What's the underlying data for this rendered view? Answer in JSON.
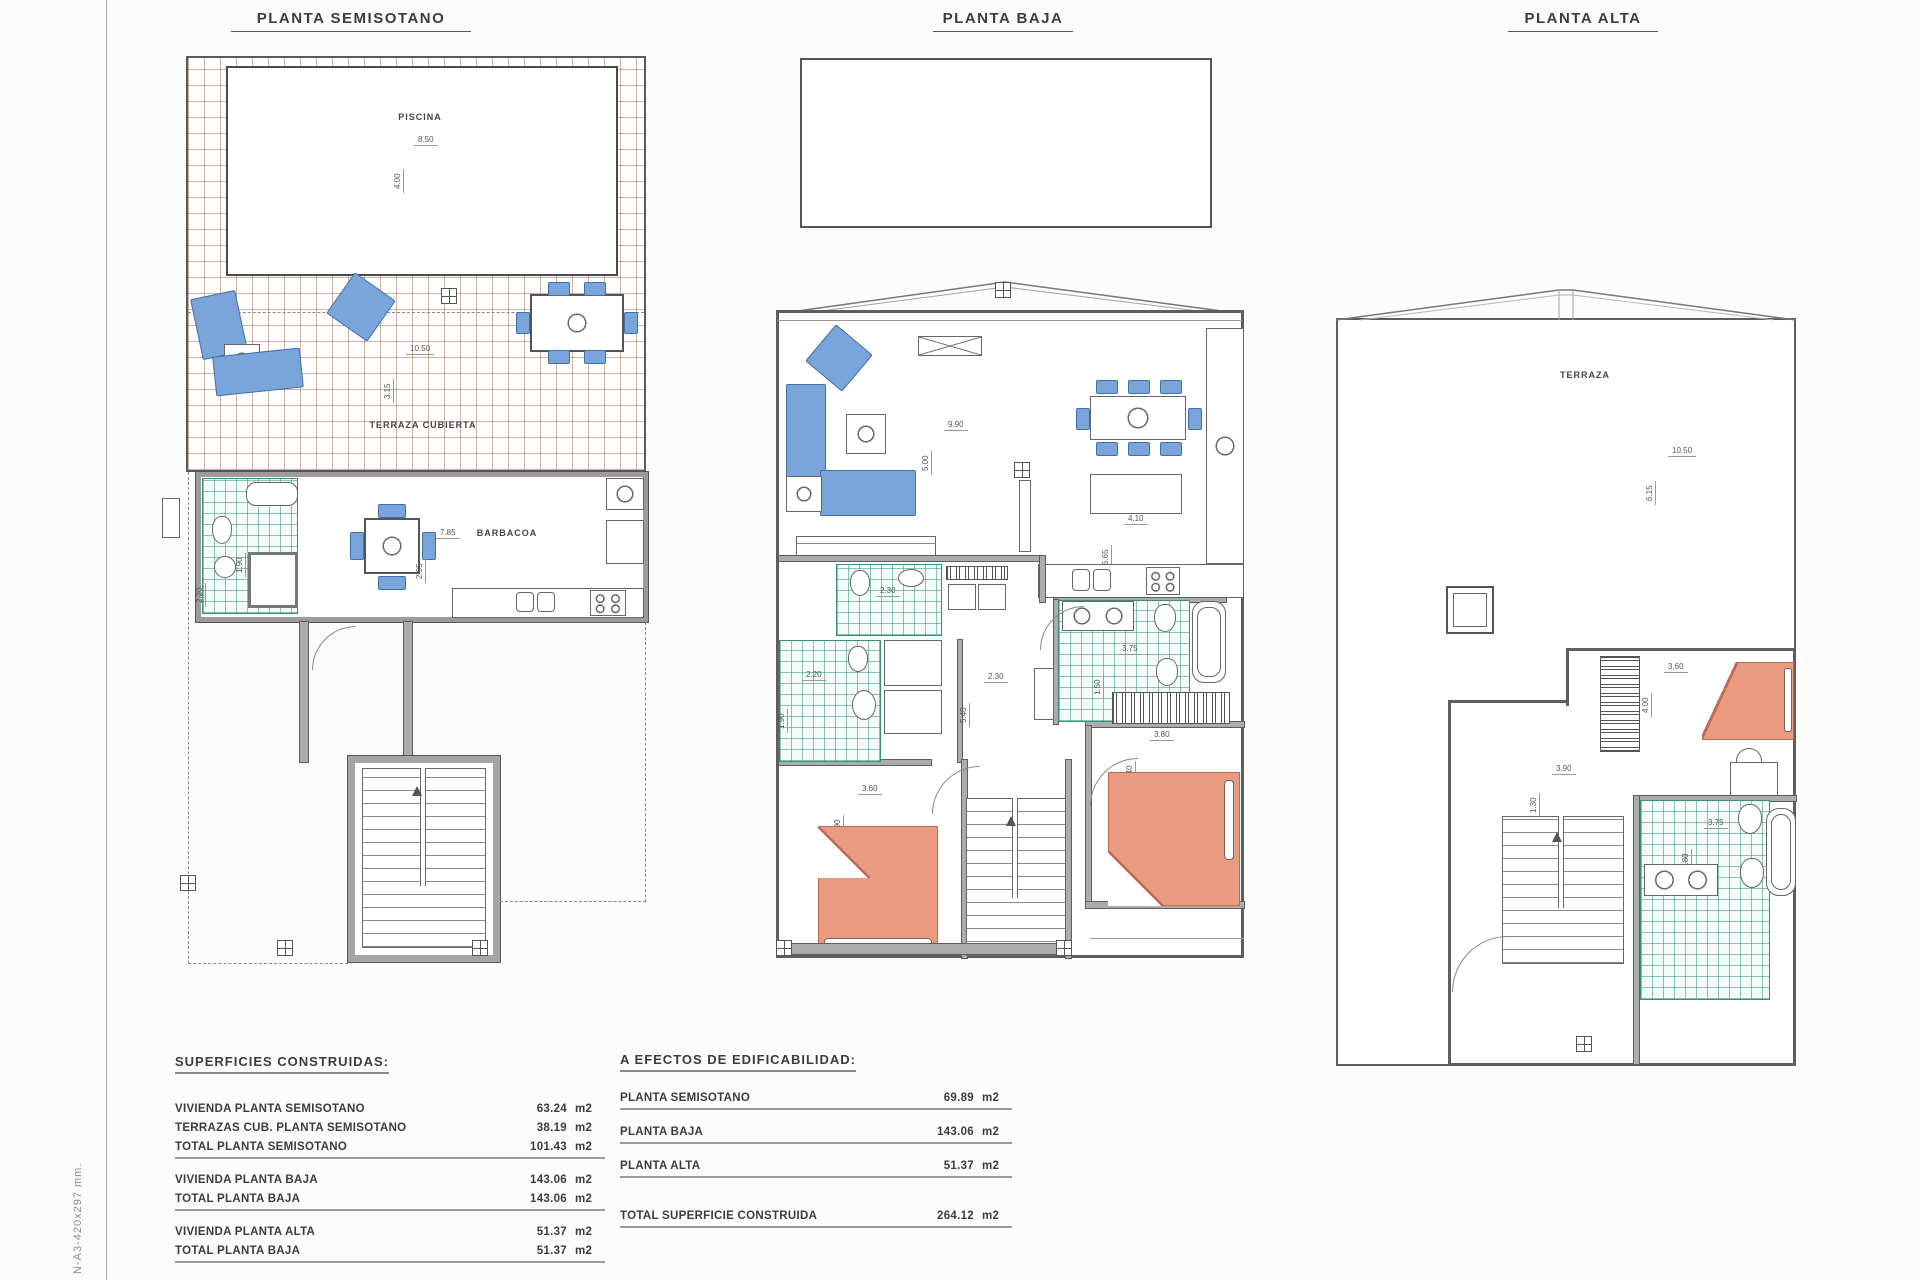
{
  "sheet": {
    "note": "N-A3-420x297 mm."
  },
  "plans": {
    "semisotano": {
      "title": "PLANTA SEMISOTANO",
      "labels": {
        "piscina": "PISCINA",
        "terraza_cubierta": "TERRAZA CUBIERTA",
        "barbacoa": "BARBACOA"
      },
      "dims": {
        "pool_w": "8.50",
        "pool_h": "4.00",
        "terrace_w": "10.50",
        "terrace_h": "3.15",
        "barbacoa_w": "7.85",
        "barbacoa_h": "2.95",
        "bath_w": "2.20",
        "bath_h": "1.90"
      }
    },
    "baja": {
      "title": "PLANTA BAJA",
      "dims": {
        "salon_w": "9.90",
        "salon_h": "5.00",
        "kitchen_w": "4.10",
        "kitchen_h": "5.65",
        "bath1_w": "2.30",
        "bath2_w": "2.20",
        "bath2_h": "1.90",
        "hall_w": "2.30",
        "hall_h": "5.40",
        "bath3_w": "3.75",
        "bath3_h": "1.50",
        "bed1_w": "3.60",
        "bed1_h": "3.90",
        "bed2_w": "3.80",
        "bed2_h": "3.40"
      }
    },
    "alta": {
      "title": "PLANTA ALTA",
      "labels": {
        "terraza": "TERRAZA"
      },
      "dims": {
        "terraza_w": "10.50",
        "terraza_h": "6.15",
        "bed_w": "3.60",
        "bed_h": "4.00",
        "landing_w": "3.90",
        "landing_h": "1.30",
        "bath_w": "3.75",
        "bath_h": "1.80"
      }
    }
  },
  "tables": {
    "superficies": {
      "heading": "SUPERFICIES CONSTRUIDAS:",
      "groups": [
        {
          "rows": [
            {
              "label": "VIVIENDA PLANTA SEMISOTANO",
              "value": "63.24",
              "unit": "m2"
            },
            {
              "label": "TERRAZAS CUB. PLANTA SEMISOTANO",
              "value": "38.19",
              "unit": "m2"
            },
            {
              "label": "TOTAL PLANTA SEMISOTANO",
              "value": "101.43",
              "unit": "m2"
            }
          ]
        },
        {
          "rows": [
            {
              "label": "VIVIENDA PLANTA BAJA",
              "value": "143.06",
              "unit": "m2"
            },
            {
              "label": "TOTAL PLANTA BAJA",
              "value": "143.06",
              "unit": "m2"
            }
          ]
        },
        {
          "rows": [
            {
              "label": "VIVIENDA PLANTA ALTA",
              "value": "51.37",
              "unit": "m2"
            },
            {
              "label": "TOTAL PLANTA BAJA",
              "value": "51.37",
              "unit": "m2"
            }
          ]
        },
        {
          "rows": [
            {
              "label": "TOTAL SUPERFICIE CONSTRUIDA",
              "value": "295.86",
              "unit": "m2"
            }
          ]
        }
      ]
    },
    "edificabilidad": {
      "heading": "A EFECTOS DE EDIFICABILIDAD:",
      "rows": [
        {
          "label": "PLANTA SEMISOTANO",
          "value": "69.89",
          "unit": "m2"
        },
        {
          "label": "PLANTA BAJA",
          "value": "143.06",
          "unit": "m2"
        },
        {
          "label": "PLANTA ALTA",
          "value": "51.37",
          "unit": "m2"
        }
      ],
      "total": {
        "label": "TOTAL SUPERFICIE CONSTRUIDA",
        "value": "264.12",
        "unit": "m2"
      }
    }
  }
}
